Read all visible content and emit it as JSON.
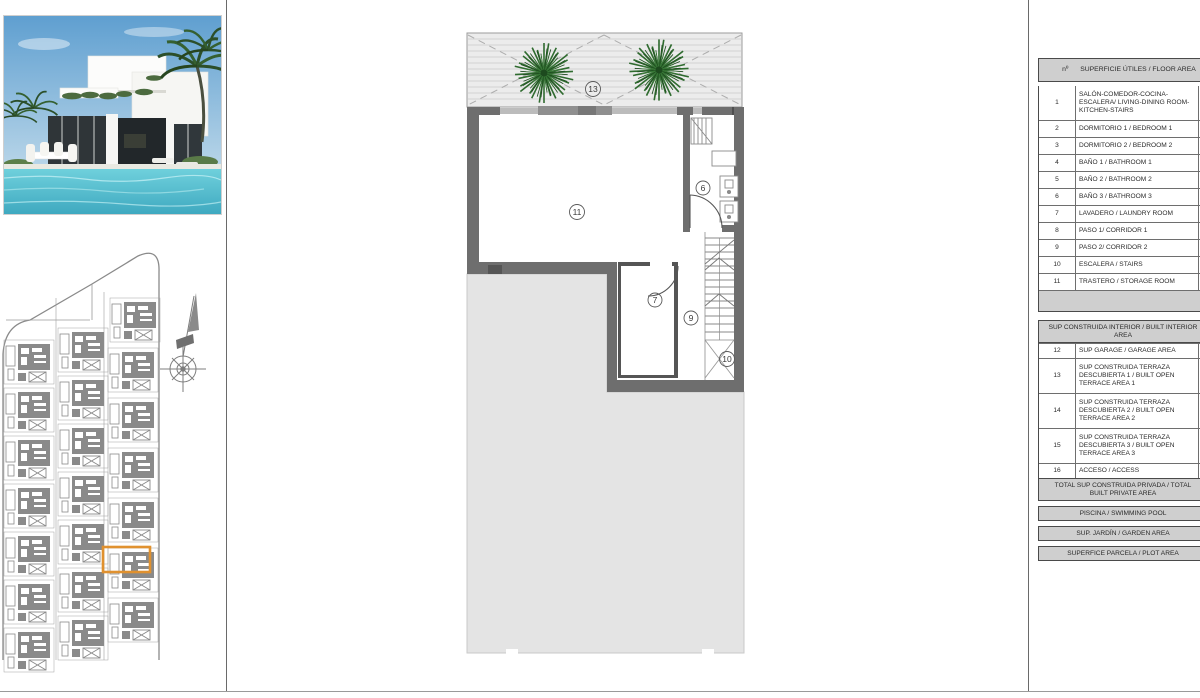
{
  "colors": {
    "band": "#cfcfcf",
    "highlight": "#e0912f",
    "garden": "#e4e4e4",
    "wall": "#6e6e6e",
    "tree": "#2f6b2f",
    "pool_dark": "#55bccd",
    "pool_light": "#8fdde7",
    "siteplan_ink": "#8a8a8a"
  },
  "plan": {
    "labels": [
      "13",
      "11",
      "6",
      "7",
      "9",
      "10"
    ]
  },
  "area_table": {
    "header": {
      "num": "nº",
      "label": "SUPERFICIE ÚTILES / FLOOR AREA"
    },
    "rows": [
      {
        "num": "1",
        "label": "SALÓN-COMEDOR-COCINA-ESCALERA/ LIVING-DINING ROOM-KITCHEN-STAIRS"
      },
      {
        "num": "2",
        "label": "DORMITORIO 1 / BEDROOM 1"
      },
      {
        "num": "3",
        "label": "DORMITORIO 2 / BEDROOM 2"
      },
      {
        "num": "4",
        "label": "BAÑO 1 / BATHROOM 1"
      },
      {
        "num": "5",
        "label": "BAÑO 2 / BATHROOM 2"
      },
      {
        "num": "6",
        "label": "BAÑO 3 / BATHROOM 3"
      },
      {
        "num": "7",
        "label": "LAVADERO / LAUNDRY ROOM"
      },
      {
        "num": "8",
        "label": "PASO 1/ CORRIDOR 1"
      },
      {
        "num": "9",
        "label": "PASO 2/ CORRIDOR 2"
      },
      {
        "num": "10",
        "label": "ESCALERA / STAIRS"
      },
      {
        "num": "11",
        "label": "TRASTERO / STORAGE ROOM"
      }
    ],
    "built_section_title": "SUP CONSTRUIDA INTERIOR / BUILT INTERIOR AREA",
    "built_rows": [
      {
        "num": "12",
        "label": "SUP GARAGE / GARAGE AREA"
      },
      {
        "num": "13",
        "label": "SUP CONSTRUIDA TERRAZA DESCUBIERTA 1 / BUILT OPEN TERRACE AREA 1"
      },
      {
        "num": "14",
        "label": "SUP CONSTRUIDA TERRAZA DESCUBIERTA 2 / BUILT OPEN TERRACE AREA 2"
      },
      {
        "num": "15",
        "label": "SUP CONSTRUIDA TERRAZA DESCUBIERTA 3 / BUILT OPEN TERRACE AREA 3"
      },
      {
        "num": "16",
        "label": "ACCESO / ACCESS"
      }
    ],
    "total_band": "TOTAL SUP CONSTRUIDA PRIVADA / TOTAL BUILT PRIVATE AREA",
    "pool_band": "PISCINA / SWIMMING POOL",
    "garden_band": "SUP. JARDÍN / GARDEN AREA",
    "plot_band": "SUPERFICE PARCELA / PLOT AREA"
  }
}
